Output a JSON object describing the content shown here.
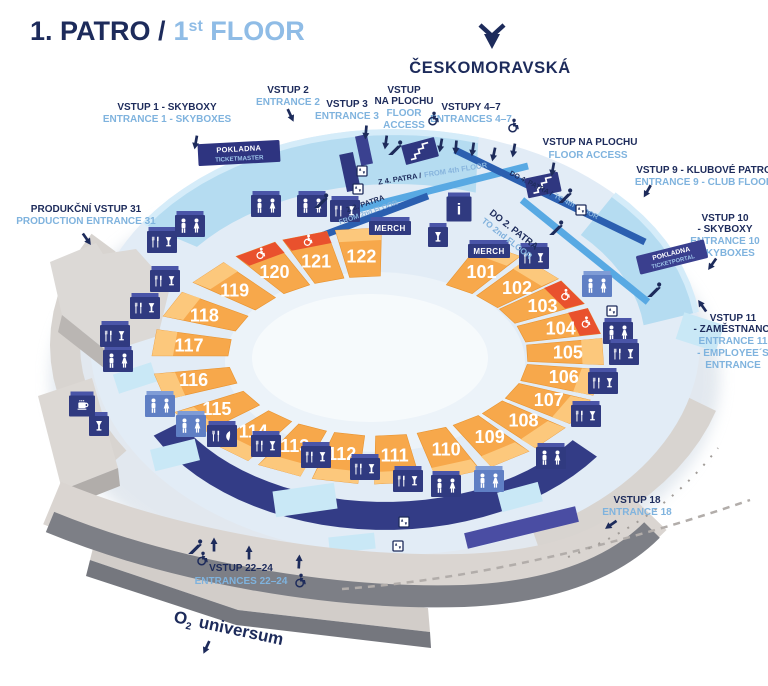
{
  "title": {
    "cz": "1. PATRO /",
    "en_num": "1",
    "en_sup": "st",
    "en_rest": " FLOOR"
  },
  "metro": {
    "station": "ČESKOMORAVSKÁ"
  },
  "entrances": {
    "e1": {
      "cz": "VSTUP 1 - SKYBOXY",
      "en": "ENTRANCE 1 - SKYBOXES"
    },
    "e2": {
      "cz": "VSTUP 2",
      "en": "ENTRANCE 2"
    },
    "e3": {
      "cz": "VSTUP 3",
      "en": "ENTRANCE 3"
    },
    "floor_access_left": {
      "cz1": "VSTUP",
      "cz2": "NA PLOCHU",
      "en1": "FLOOR",
      "en2": "ACCESS"
    },
    "e47": {
      "cz": "VSTUPY 4–7",
      "en": "ENTRANCES 4–7"
    },
    "floor_access_center": {
      "cz": "VSTUP NA PLOCHU",
      "en": "FLOOR ACCESS"
    },
    "e9": {
      "cz": "VSTUP 9 - KLUBOVÉ PATRO",
      "en": "ENTRANCE 9 - CLUB FLOOR"
    },
    "e10": {
      "cz1": "VSTUP 10",
      "cz2": "- SKYBOXY",
      "en1": "ENTRANCE 10",
      "en2": "- SKYBOXES"
    },
    "e11": {
      "cz1": "VSTUP 11",
      "cz2": "- ZAMĚSTNANCI",
      "en1": "ENTRANCE 11",
      "en2": "- EMPLOYEE´S",
      "en3": "ENTRANCE"
    },
    "e31": {
      "cz": "PRODUKČNÍ VSTUP 31",
      "en": "PRODUCTION ENTRANCE 31"
    },
    "e18": {
      "cz": "VSTUP 18",
      "en": "ENTRANCE 18"
    },
    "e2224": {
      "cz": "VSTUP 22–24",
      "en": "ENTRANCES 22–24"
    }
  },
  "box_offices": {
    "left": {
      "cz": "POKLADNA",
      "vendor": "TICKETMASTER"
    },
    "right": {
      "cz": "POKLADNA",
      "vendor": "TICKETPORTAL"
    }
  },
  "escalator_links": {
    "z4": {
      "cz": "Z 4. PATRA /",
      "en": "FROM 4th FLOOR"
    },
    "do4": {
      "cz": "DO 4. PATRA /",
      "en": "TO 4th FLOOR"
    },
    "z2": {
      "cz": "Z 2. PATRA",
      "en": "FROM 2nd FLOOR"
    },
    "do2": {
      "cz": "DO 2. PATRA",
      "en": "TO 2nd FLOOR"
    }
  },
  "sections": {
    "numbers": [
      "101",
      "102",
      "103",
      "104",
      "105",
      "106",
      "107",
      "108",
      "109",
      "110",
      "111",
      "112",
      "113",
      "114",
      "115",
      "116",
      "117",
      "118",
      "119",
      "120",
      "121",
      "122"
    ],
    "wheelchair_accessible": [
      "103",
      "104",
      "120",
      "121"
    ]
  },
  "stands": {
    "merch": "MERCH",
    "info": "i"
  },
  "amenities": [
    {
      "type": "restroom"
    },
    {
      "type": "restroom"
    },
    {
      "type": "food-drink"
    },
    {
      "type": "merch"
    },
    {
      "type": "drink"
    },
    {
      "type": "merch"
    },
    {
      "type": "food-drink"
    },
    {
      "type": "info"
    },
    {
      "type": "restroom"
    },
    {
      "type": "restroom"
    },
    {
      "type": "food-drink"
    },
    {
      "type": "food-drink"
    },
    {
      "type": "food-drink"
    },
    {
      "type": "restroom"
    },
    {
      "type": "restroom"
    },
    {
      "type": "restroom"
    },
    {
      "type": "food-drink"
    },
    {
      "type": "food-drink"
    },
    {
      "type": "food-drink"
    },
    {
      "type": "food-drink"
    },
    {
      "type": "food-veg"
    },
    {
      "type": "restroom"
    },
    {
      "type": "restroom"
    },
    {
      "type": "drink"
    },
    {
      "type": "coffee"
    },
    {
      "type": "restroom"
    },
    {
      "type": "food-drink"
    },
    {
      "type": "food-drink"
    },
    {
      "type": "food-drink"
    },
    {
      "type": "food-drink"
    },
    {
      "type": "restroom"
    }
  ],
  "neighbor": {
    "o2_pre": "O",
    "o2_sub": "2",
    "o2_rest": " universum"
  },
  "colors": {
    "navy": "#1d2b5b",
    "light_blue_text": "#7fb3de",
    "orange": "#f7a84b",
    "orange_light": "#fcc87c",
    "red_accessible": "#e9512d",
    "cube_navy": "#303a80",
    "cube_blue": "#5f7fc4",
    "skybox": "#b5dcf1",
    "skybox_light": "#d5ecf9",
    "floor": "#e2ecf6",
    "walkway_gray": "#dad5d1",
    "bar_blue": "#58a9e3",
    "bar_dark": "#2b5fb0",
    "wall_navy": "#333c86"
  }
}
